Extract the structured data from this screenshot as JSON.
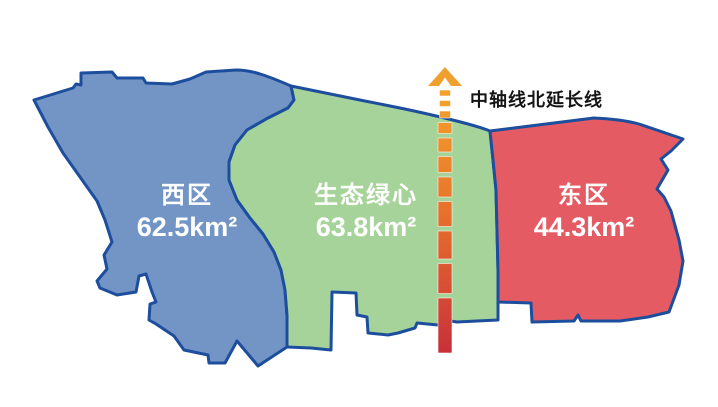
{
  "map": {
    "regions": [
      {
        "id": "west-district",
        "name": "西区",
        "area": "62.5km²",
        "color": "#7295c5"
      },
      {
        "id": "green-heart",
        "name": "生态绿心",
        "area": "63.8km²",
        "color": "#a6d399"
      },
      {
        "id": "east-district",
        "name": "东区",
        "area": "44.3km²",
        "color": "#e55b64"
      }
    ],
    "axis": {
      "label": "中轴线北延长线",
      "arrow_color": "#efa02f",
      "gradient": [
        "#f3a42c",
        "#e8732c",
        "#c8303a"
      ]
    },
    "border_color": "#1d4e9e",
    "label_text_color": "#ffffff",
    "background_color": "#ffffff"
  }
}
